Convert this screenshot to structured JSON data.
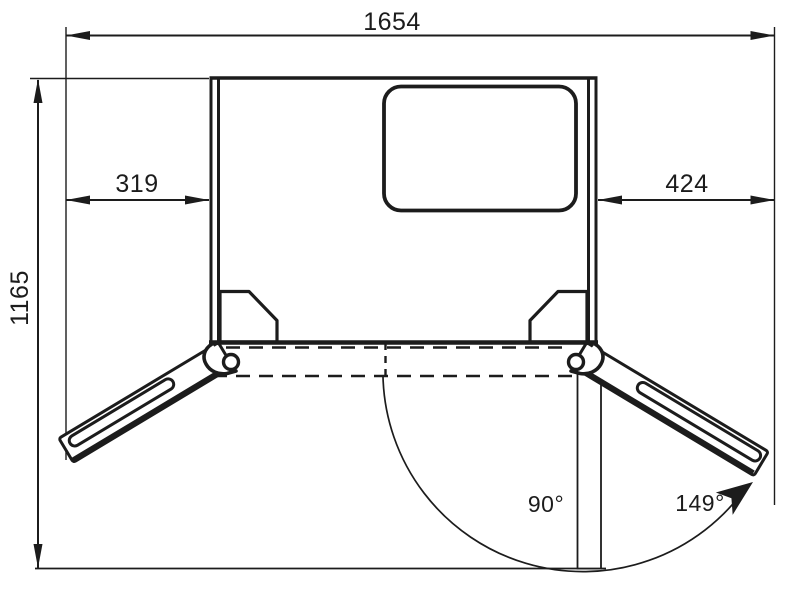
{
  "diagram": {
    "type": "technical-dimension-drawing",
    "subject": "refrigerator-top-view-door-opening-clearance",
    "dimensions": {
      "overall_width": "1654",
      "overall_depth": "1165",
      "left_door_protrusion": "319",
      "right_door_protrusion": "424"
    },
    "angles": {
      "door_position_90": "90°",
      "door_max_open": "149°"
    },
    "colors": {
      "line": "#1c1c1c",
      "background": "#ffffff"
    }
  }
}
